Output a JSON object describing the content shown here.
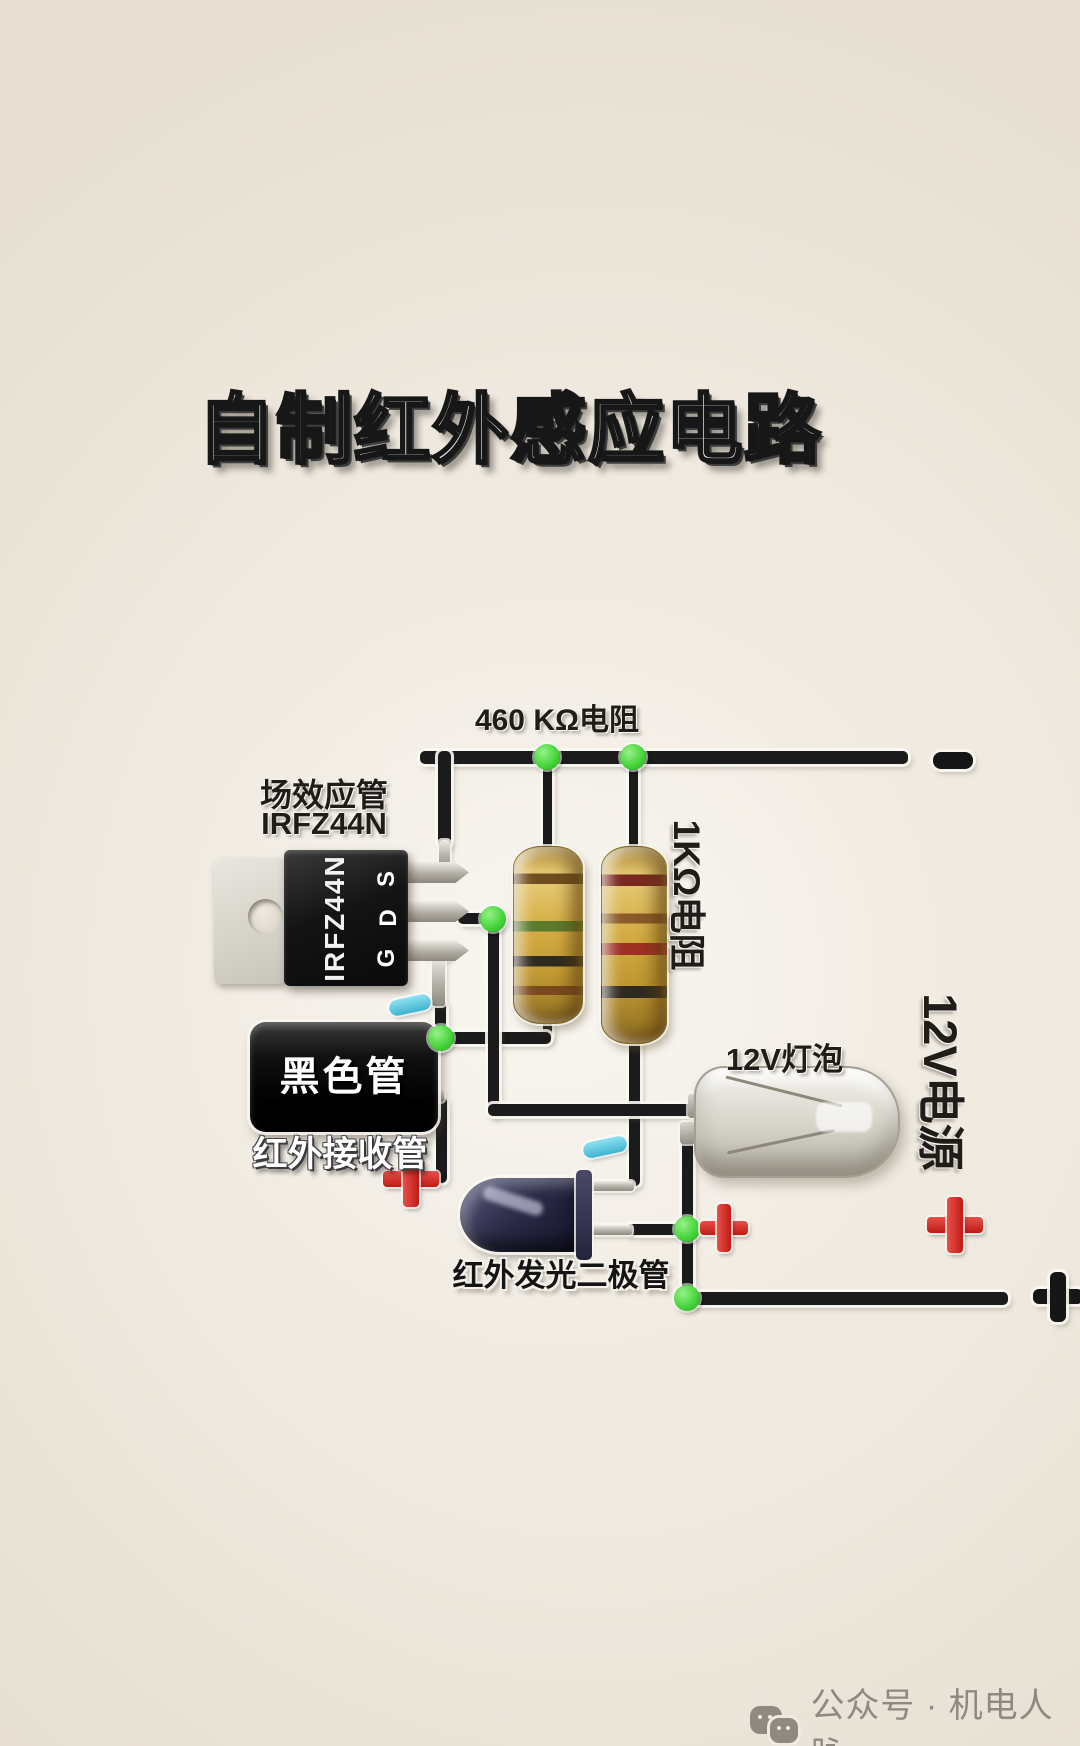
{
  "title": "自制红外感应电路",
  "labels": {
    "resistor_460k": "460 KΩ电阻",
    "mosfet_name": "场效应管",
    "mosfet_part": "IRFZ44N",
    "resistor_1k": "1KΩ电阻",
    "bulb": "12V灯泡",
    "power": "12V电源",
    "black_tube": "黑色管",
    "ir_receiver": "红外接收管",
    "ir_led": "红外发光二极管"
  },
  "mosfet": {
    "print": "IRFZ44N",
    "pins": {
      "s": "S",
      "d": "D",
      "g": "G"
    }
  },
  "terminals": {
    "negative": "−",
    "positive": "+"
  },
  "polarity_marks": {
    "positive": "+",
    "negative": "−"
  },
  "watermark": {
    "icon": "wechat-icon",
    "text": "公众号 · 机电人脉"
  },
  "colors": {
    "background": "#efe9df",
    "wire": "#1b1b1b",
    "junction_green": "#44d338",
    "positive_red": "#d2221c",
    "negative_blue": "#4fc3d9",
    "resistor_gold": "#d4ae44"
  }
}
